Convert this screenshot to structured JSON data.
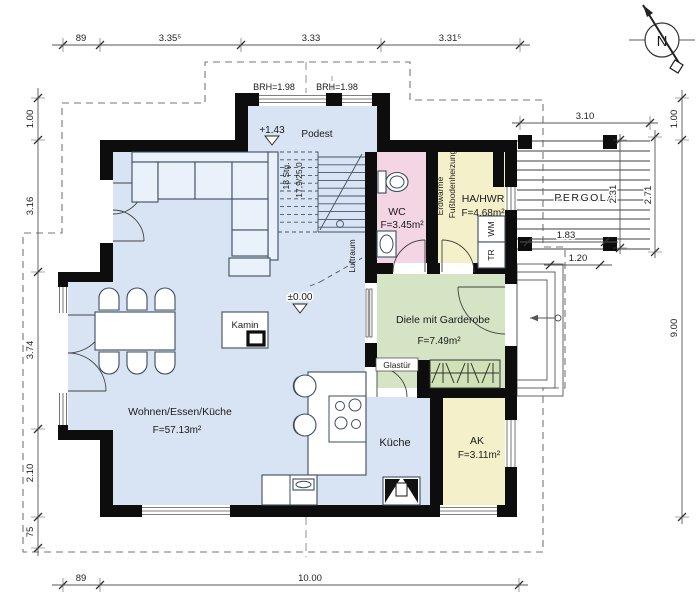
{
  "labels": {
    "living_name": "Wohnen/Essen/Küche",
    "living_area": "F=57.13m²",
    "kitchen": "Küche",
    "wc_name": "WC",
    "wc_area": "F=3.45m²",
    "util_name": "HA/HWR",
    "util_area": "F=4.68m²",
    "util_heat1": "Erdwärme",
    "util_heat2": "Fußbodenheizung",
    "washer": "WM",
    "dryer": "TR",
    "hall_name": "Diele mit Garderobe",
    "hall_area": "F=7.49m²",
    "ak_name": "AK",
    "ak_area": "F=3.11m²",
    "podest": "Podest",
    "luftraum": "Luftraum",
    "stairs_count": "18 Stg.",
    "stairs_ratio": "17,9/25,0",
    "level_podest": "+1.43",
    "level_ground": "±0.00",
    "brh_left": "BRH=1.98",
    "brh_right": "BRH=1.98",
    "kamin": "Kamin",
    "glastuer": "Glastür",
    "pergola": "PERGOLA",
    "compass_n": "N"
  },
  "dims": {
    "top": [
      "89",
      "3.35⁵",
      "3.33",
      "3.31⁵"
    ],
    "left": [
      "1.00",
      "3.16",
      "3.74",
      "2.10",
      "75"
    ],
    "bottom": [
      "89",
      "10.00"
    ],
    "right": [
      "1.00",
      "9.00"
    ],
    "pergola_v": [
      "2.71",
      "2.31"
    ],
    "pergola_h": [
      "3.10",
      "1.83",
      "1.20"
    ]
  },
  "colors": {
    "floor_living": "#d8e4f4",
    "floor_wc": "#f3d5e4",
    "floor_util": "#f4f0ca",
    "floor_hall": "#d4e4c4",
    "floor_wardrobe": "#cfe2b6",
    "wall": "#0d0d0d"
  }
}
